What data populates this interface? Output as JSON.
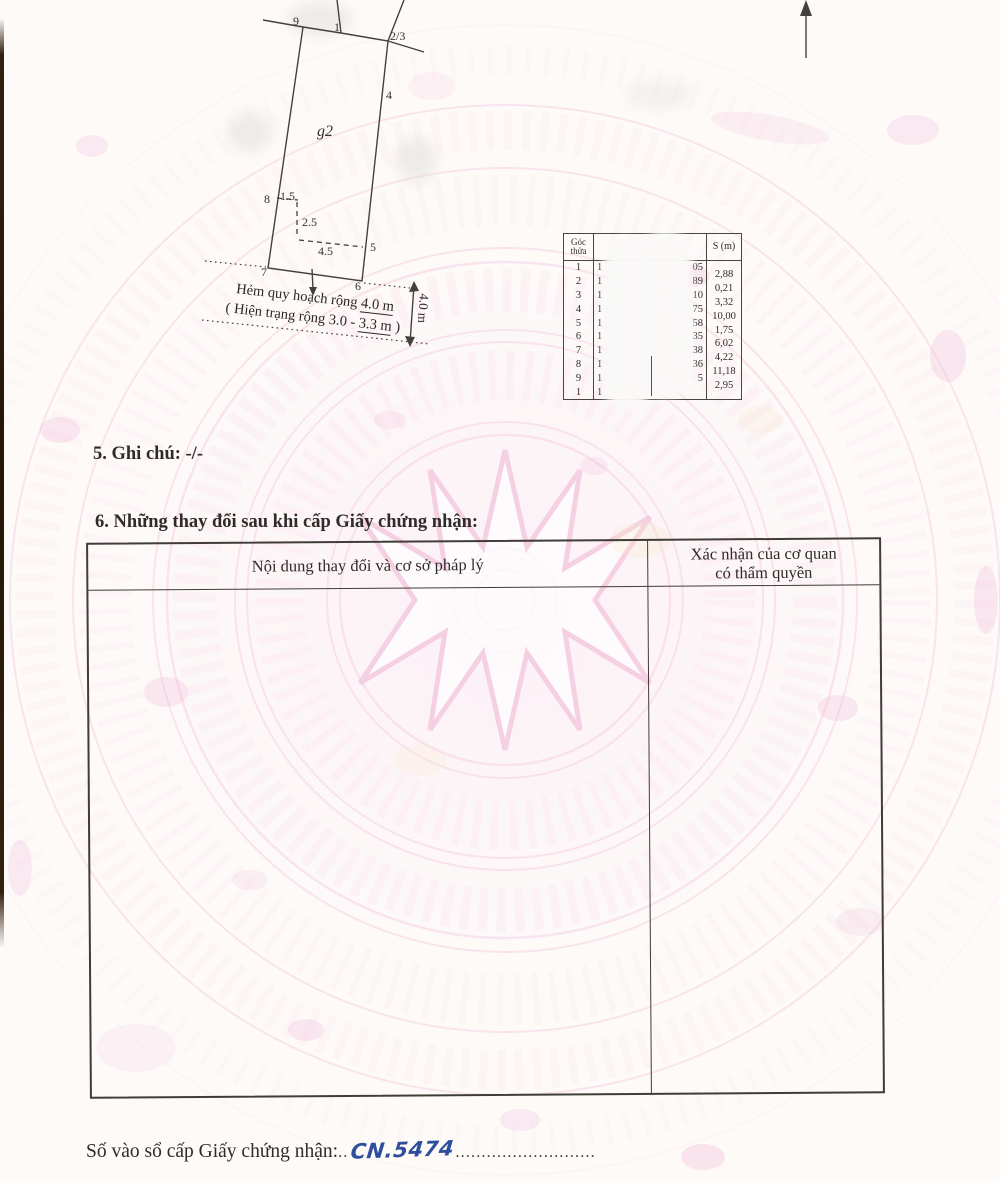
{
  "document": {
    "section5": "5. Ghi chú: -/-",
    "section6_title": "6. Những thay đổi sau khi cấp Giấy chứng nhận:",
    "change_table": {
      "left_header": "Nội dung thay đổi và cơ sở pháp lý",
      "right_header_line1": "Xác nhận của cơ quan",
      "right_header_line2": "có thẩm quyền"
    },
    "footer": {
      "label": "Số vào sổ cấp Giấy chứng nhận:",
      "leader_pre": "..",
      "book_number": "CN.5474",
      "leader_post": "..........................."
    }
  },
  "plot_diagram": {
    "parcel_label": "g2",
    "vertices": {
      "v9": "9",
      "v1": "1",
      "v23": "2/3",
      "v4": "4",
      "v5": "5",
      "v6": "6",
      "v7": "7",
      "v8": "8"
    },
    "inner_dims": {
      "d1": "1.5",
      "d2": "2.5",
      "d3": "4.5"
    },
    "road_note_line1_text": "Hẻm quy hoạch rộng ",
    "road_note_line1_underline": "4.0 m",
    "road_note_line2_text": "( Hiện trạng rộng 3.0 - ",
    "road_note_line2_underline": "3.3 m",
    "road_note_line2_close": " )",
    "road_width_arrow_label": "4.0 m"
  },
  "coordinate_table": {
    "corner_header_line1": "Góc",
    "corner_header_line2": "thửa",
    "s_header": "S (m)",
    "rows": [
      {
        "corner": "1",
        "lead": "1",
        "frag": "05"
      },
      {
        "corner": "2",
        "lead": "1",
        "frag": "89"
      },
      {
        "corner": "3",
        "lead": "1",
        "frag": "10"
      },
      {
        "corner": "4",
        "lead": "1",
        "frag": "75"
      },
      {
        "corner": "5",
        "lead": "1",
        "frag": "58"
      },
      {
        "corner": "6",
        "lead": "1",
        "frag": "35"
      },
      {
        "corner": "7",
        "lead": "1",
        "frag": "38"
      },
      {
        "corner": "8",
        "lead": "1",
        "frag": "36"
      },
      {
        "corner": "9",
        "lead": "1",
        "frag": "5"
      },
      {
        "corner": "1",
        "lead": "1",
        "frag": ""
      }
    ],
    "s_values": [
      "2,88",
      "0,21",
      "3,32",
      "10,00",
      "1,75",
      "6,02",
      "4,22",
      "11,18",
      "2,95"
    ]
  },
  "colors": {
    "ink": "#2e2b28",
    "handwriting_blue": "#2f4f9d",
    "watermark_pink": "#f6cce1",
    "paper": "#fdfaf8"
  }
}
